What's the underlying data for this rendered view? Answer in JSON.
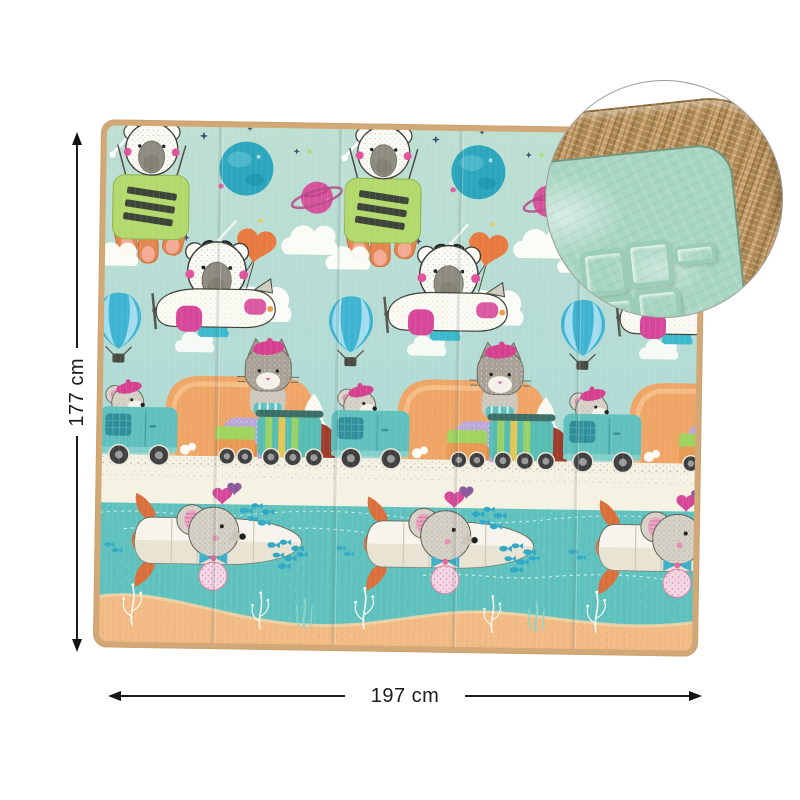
{
  "dimension_annotations": {
    "height": "177 cm",
    "width": "197 cm"
  },
  "detail_view": {
    "icon": "zoom-detail-circle",
    "shows": [
      "woven-tan-edge-binding",
      "embossed-mint-foam-surface"
    ]
  },
  "illustration_motifs": [
    "koala-in-green-lander",
    "koala-pilot-in-white-plane",
    "heart-balloon",
    "hot-air-balloon",
    "teal-planet",
    "pink-ringed-planet",
    "stars",
    "shooting-star",
    "clouds",
    "cat-with-beret-on-train",
    "mouse-driving-teal-truck",
    "orange-tunnel",
    "white-tree",
    "mouse-in-white-submarine",
    "fish-school",
    "seaweed",
    "sand",
    "water"
  ],
  "mat": {
    "visible_fold_panels": 5
  },
  "palette": {
    "background": "#ffffff",
    "mat_sky": "#b9ddd3",
    "water": "#5fc1bd",
    "sand": "#f2bb85",
    "road_strip": "#f5f1e3",
    "mat_edge_tan": "#d2a877",
    "lander_green": "#b3d96d",
    "accent_magenta": "#d6418f",
    "planet_teal": "#2ba6bd",
    "planet_pink": "#d6539c",
    "balloon_blue": "#3fb4d2",
    "truck_teal": "#5fc0bd",
    "tunnel_orange": "#efa566",
    "fin_orange": "#d96f3b",
    "train_teal": "#57bdb2",
    "train_green": "#9fd45f",
    "weave_tan": "#bb9257",
    "surface_mint": "#a7d6c2",
    "arrow_color": "#1b1b1b"
  }
}
